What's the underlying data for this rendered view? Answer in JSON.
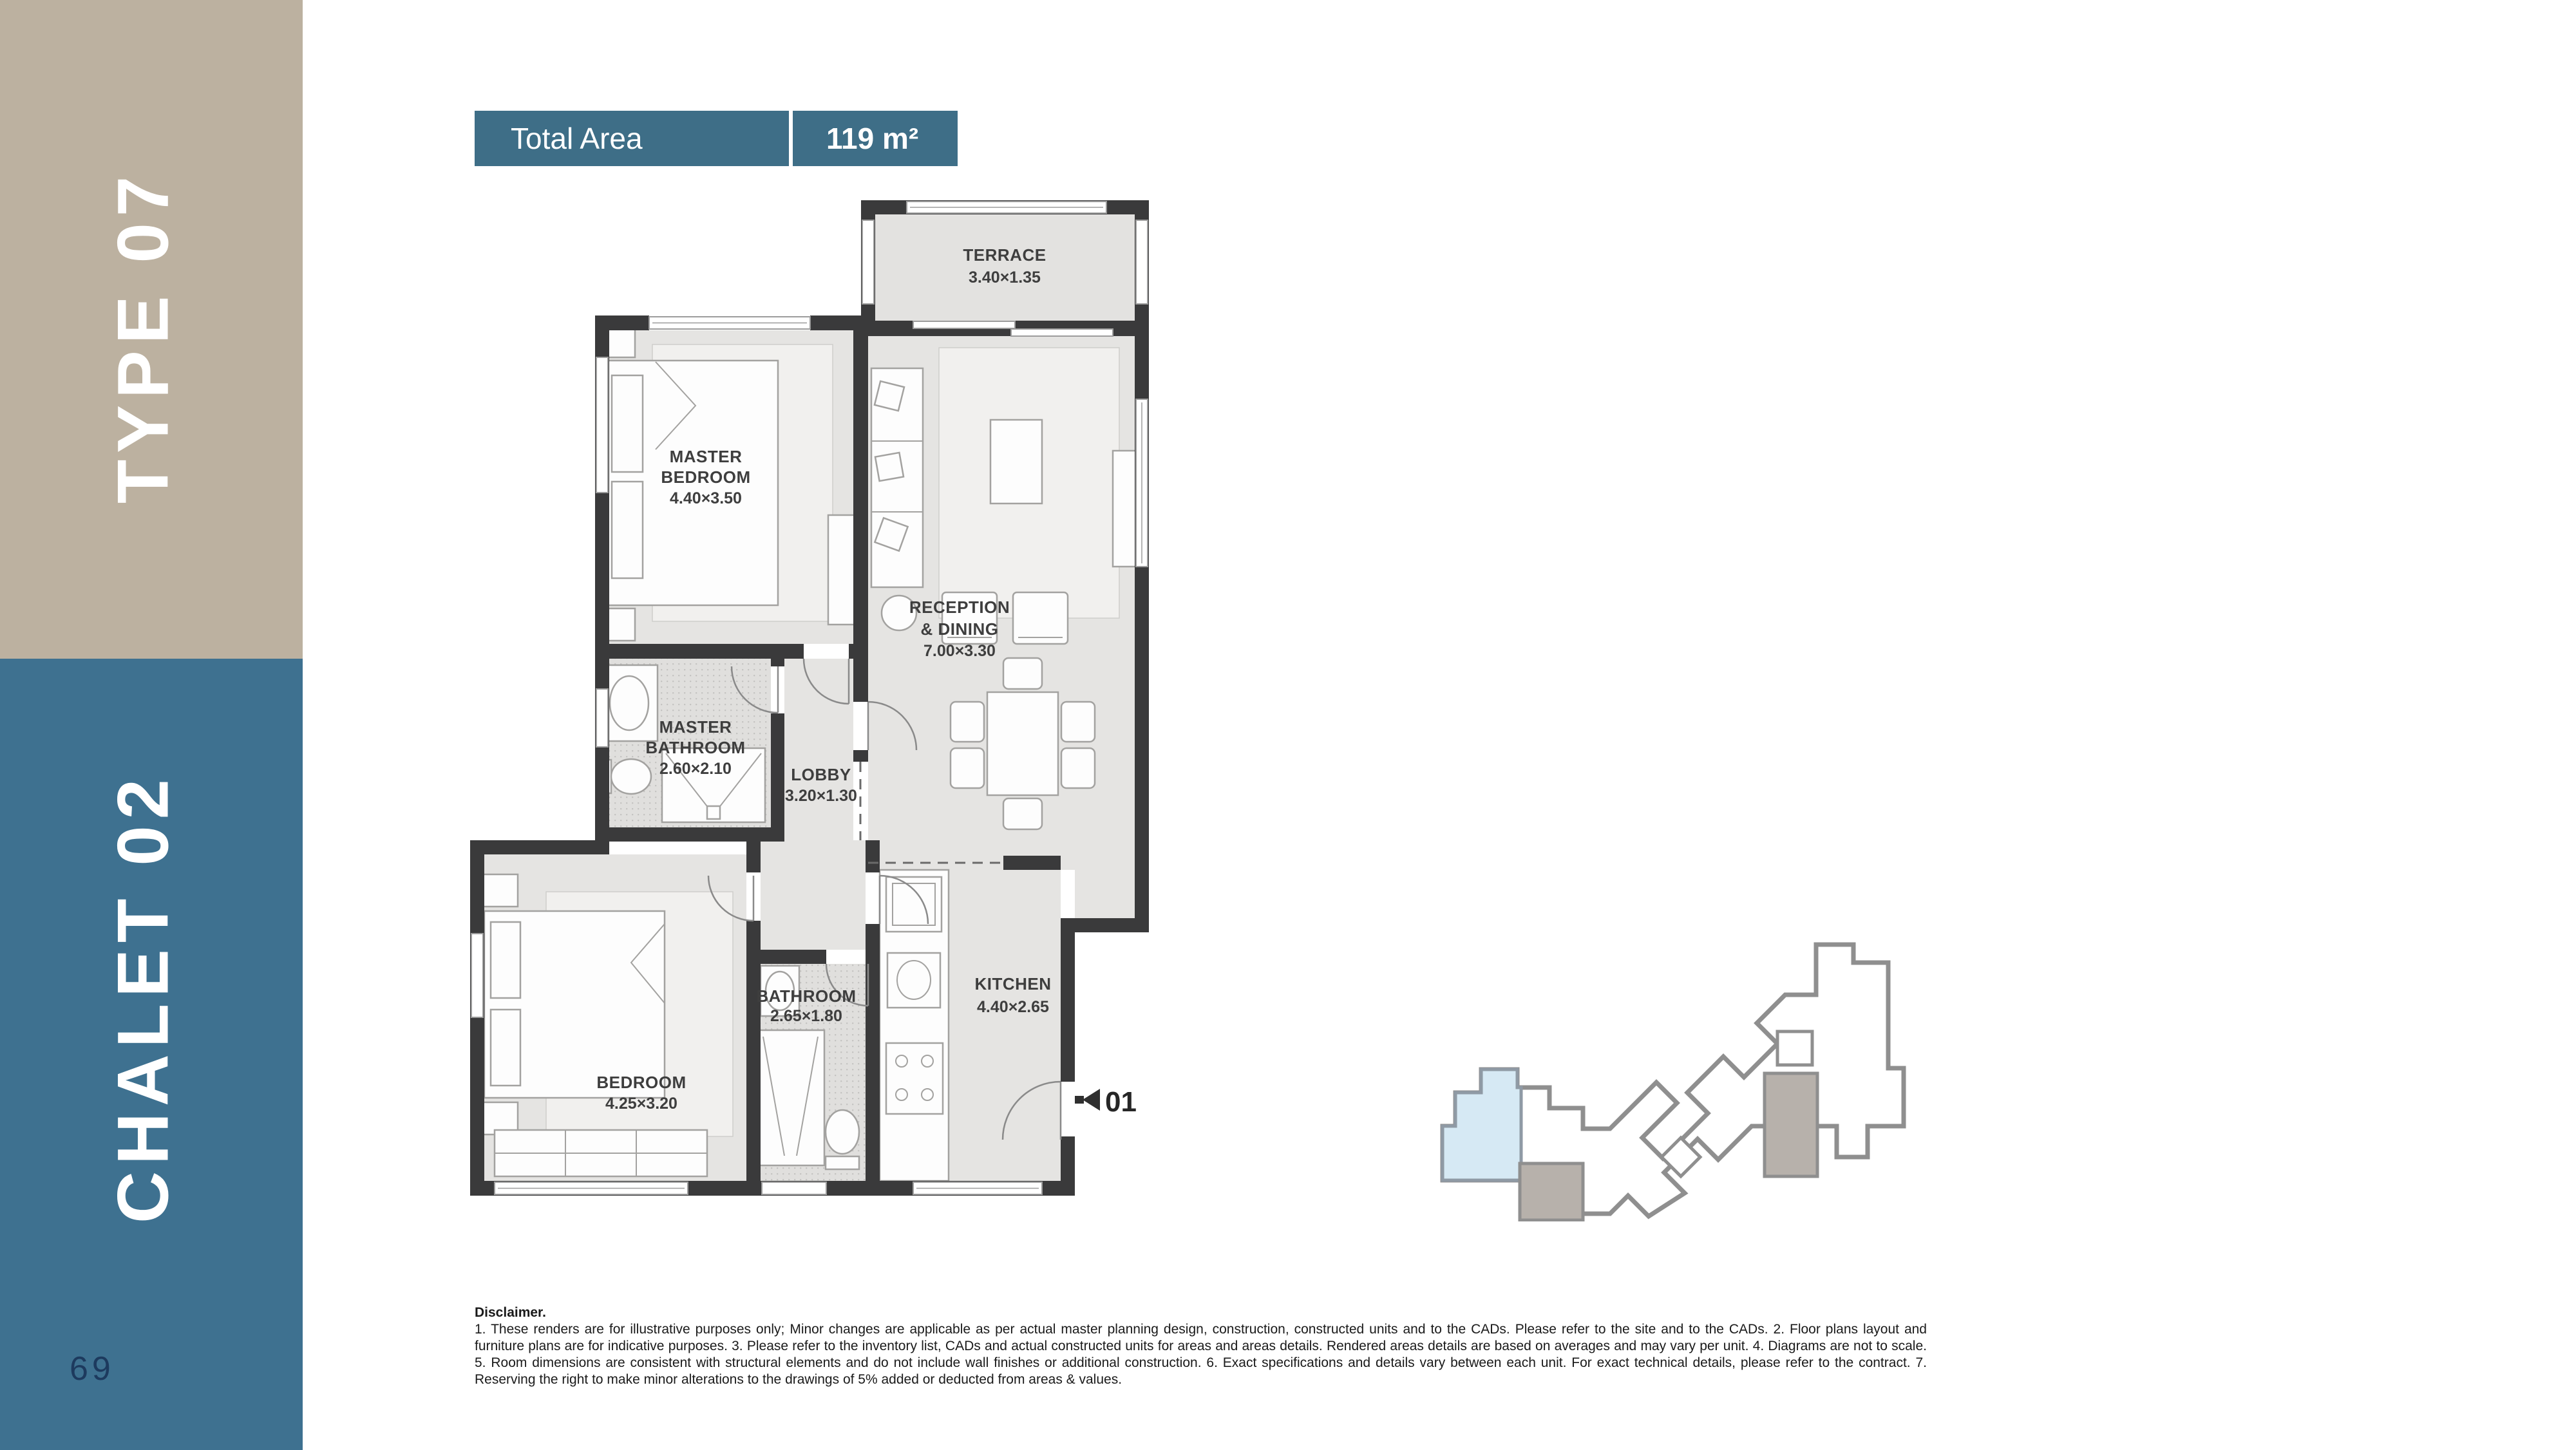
{
  "page": {
    "number": "69"
  },
  "sidebar": {
    "type_label": "TYPE 07",
    "chalet_label": "CHALET 02",
    "tan_color": "#bcb1a0",
    "teal_color": "#3e7190",
    "page_number_color": "#1d3a5e"
  },
  "header": {
    "label": "Total Area",
    "value": "119 m²",
    "bar_color": "#3e6e87"
  },
  "floor_plan": {
    "wall_color": "#3a3a3b",
    "floor_color": "#e5e4e2",
    "entrance_label": "01",
    "rooms": {
      "terrace": {
        "lines": [
          "TERRACE",
          "3.40×1.35"
        ]
      },
      "master_bedroom": {
        "lines": [
          "MASTER",
          "BEDROOM",
          "4.40×3.50"
        ]
      },
      "reception": {
        "lines": [
          "RECEPTION",
          "& DINING",
          "7.00×3.30"
        ]
      },
      "master_bathroom": {
        "lines": [
          "MASTER",
          "BATHROOM",
          "2.60×2.10"
        ]
      },
      "lobby": {
        "lines": [
          "LOBBY",
          "3.20×1.30"
        ]
      },
      "bedroom": {
        "lines": [
          "BEDROOM",
          "4.25×3.20"
        ]
      },
      "bathroom": {
        "lines": [
          "BATHROOM",
          "2.65×1.80"
        ]
      },
      "kitchen": {
        "lines": [
          "KITCHEN",
          "4.40×2.65"
        ]
      }
    }
  },
  "site_plan": {
    "highlight_color": "#d6e9f4",
    "block_color": "#b7b1ab",
    "outline_color": "#8f8f8f"
  },
  "disclaimer": {
    "title": "Disclaimer.",
    "body": "1. These renders are for illustrative purposes only; Minor changes are applicable as per actual master planning design, construction, constructed units and to the CADs. Please refer to the site and to the CADs. 2. Floor plans layout and furniture plans are for indicative purposes. 3. Please refer to the inventory list, CADs and actual constructed units for areas and areas details. Rendered areas details are based on averages and may vary per unit. 4. Diagrams are not to scale. 5. Room dimensions are consistent with structural elements and do not include wall finishes or additional construction. 6. Exact specifications and details vary between each unit. For exact technical details, please refer to the contract. 7. Reserving the right to make minor alterations to the drawings of 5% added or deducted from areas & values."
  }
}
